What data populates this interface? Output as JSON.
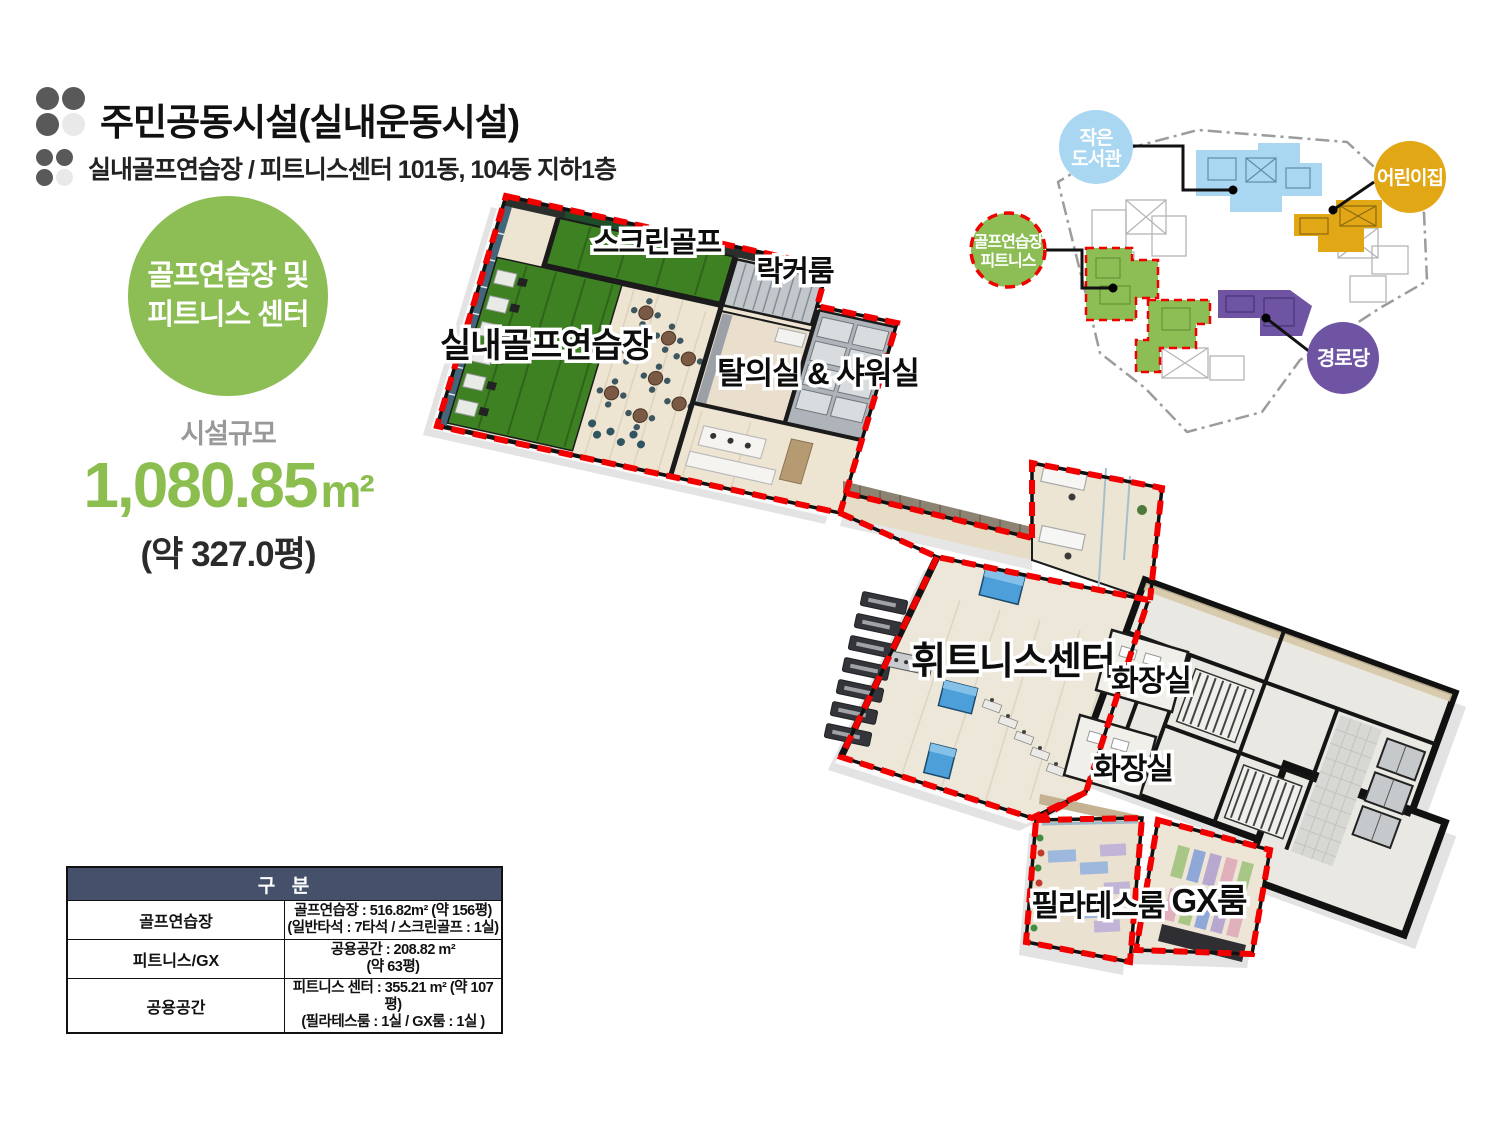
{
  "slide": {
    "title": "주민공동시설(실내운동시설)",
    "subtitle": "실내골프연습장 / 피트니스센터 101동, 104동 지하1층"
  },
  "badge": {
    "line1": "골프연습장 및",
    "line2": "피트니스 센터"
  },
  "facility": {
    "scale_label": "시설규모",
    "area_value": "1,080.85",
    "area_unit": "m²",
    "pyeong": "(약 327.0평)"
  },
  "table": {
    "header": "구  분",
    "rows": [
      {
        "category": "골프연습장",
        "line1": "골프연습장 : 516.82m² (약 156평)",
        "line2": "(일반타석 : 7타석 / 스크린골프 : 1실)"
      },
      {
        "category": "피트니스/GX",
        "line1": "공용공간 : 208.82 m²",
        "line2": "(약 63평)"
      },
      {
        "category": "공용공간",
        "line1": "피트니스 센터 : 355.21 m² (약 107평)",
        "line2": "(필라테스룸 : 1실 / GX룸 : 1실 )"
      }
    ]
  },
  "floorplan": {
    "labels": {
      "screen_golf": "스크린골프",
      "locker": "락커룸",
      "indoor_golf": "실내골프연습장",
      "dressing": "탈의실 & 샤워실",
      "fitness": "휘트니스센터",
      "restroom1": "화장실",
      "restroom2": "화장실",
      "pilates": "필라테스룸",
      "gx": "GX룸"
    }
  },
  "sitemap": {
    "library_line1": "작은",
    "library_line2": "도서관",
    "daycare": "어린이집",
    "golf_line1": "골프연습장",
    "golf_line2": "피트니스",
    "senior": "경로당"
  },
  "colors": {
    "accent_green": "#8CBE55",
    "number_green": "#8CBE4F",
    "highlight_red": "#F20000",
    "table_header_navy": "#45516B",
    "library_blue": "#A9D7F2",
    "daycare_orange": "#E2A715",
    "senior_purple": "#6F54A4",
    "turf_green": "#3E8122"
  }
}
